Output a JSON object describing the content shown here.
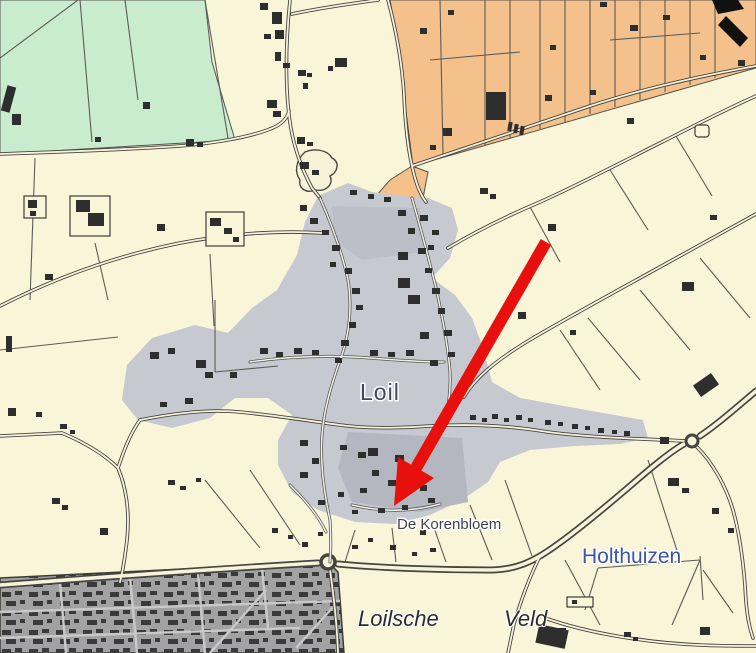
{
  "map": {
    "place_labels": [
      {
        "text": "Loil",
        "type": "village-name"
      },
      {
        "text": "De Korenbloem",
        "type": "street-name"
      },
      {
        "text": "Holthuizen",
        "type": "hamlet-name"
      },
      {
        "text": "Loilsche",
        "type": "field-name"
      },
      {
        "text": "Veld",
        "type": "field-name"
      }
    ],
    "colors": {
      "background": "#f9f5d8",
      "green_zone": "#c9ebce",
      "orange_zone": "#f4c18c",
      "built_up": "#c7c9d1",
      "built_up_dark": "#b4b6c0",
      "urban_base": "#a2a2a2",
      "building": "#2e2e2e",
      "arrow_red": "#e8100d",
      "label_village": "#3f4a5f",
      "label_street": "#3e434e",
      "label_hamlet": "#3c55a5",
      "label_field": "#2b2b30"
    },
    "annotation_arrow": {
      "color": "#e8100d",
      "shape": "thick-arrow-pointing-down-left"
    }
  }
}
